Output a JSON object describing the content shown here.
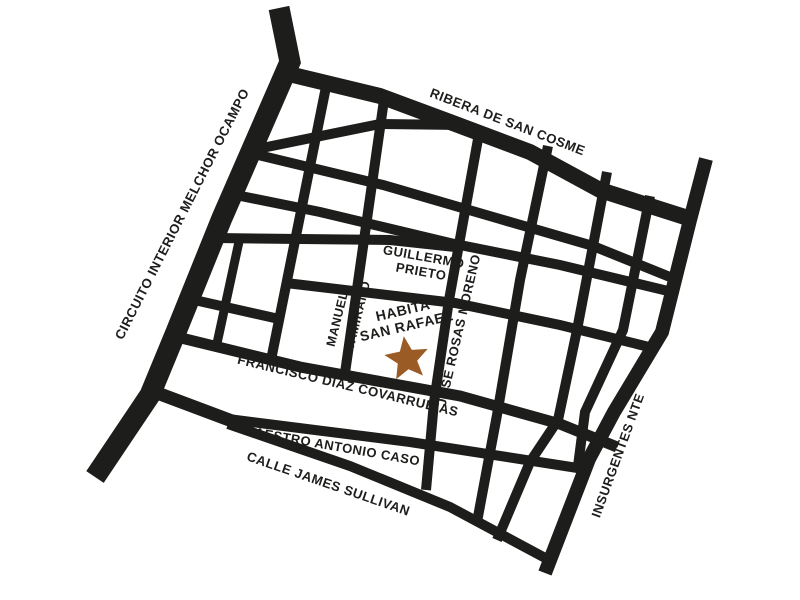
{
  "map": {
    "background_color": "#ffffff",
    "street_color": "#1d1d1b",
    "label_color": "#1d1d1b",
    "streets": {
      "circuito_interior": {
        "label": "CIRCUITO INTERIOR MELCHOR OCAMPO"
      },
      "ribera_san_cosme": {
        "label": "RIBERA DE SAN COSME"
      },
      "guillermo_prieto": {
        "label_line1": "GUILLERMO",
        "label_line2": "PRIETO"
      },
      "manuel_altamirano": {
        "label_line1": "MANUEL",
        "label_line2": "ALTAMIRANO"
      },
      "jose_rosas_moreno": {
        "label": "JOSE ROSAS MORENO"
      },
      "francisco_diaz_covarrubias": {
        "label": "FRANCISCO DÍAZ COVARRUBIAS"
      },
      "maestro_antonio_caso": {
        "label": "MAESTRO ANTONIO CASO"
      },
      "calle_james_sullivan": {
        "label": "CALLE JAMES SULLIVAN"
      },
      "insurgentes_nte": {
        "label": "INSURGENTES NTE"
      }
    },
    "marker": {
      "label_line1": "HABITA",
      "label_line2": "SAN RAFAEL",
      "icon": "star-icon",
      "star_color": "#9a5b25"
    }
  }
}
